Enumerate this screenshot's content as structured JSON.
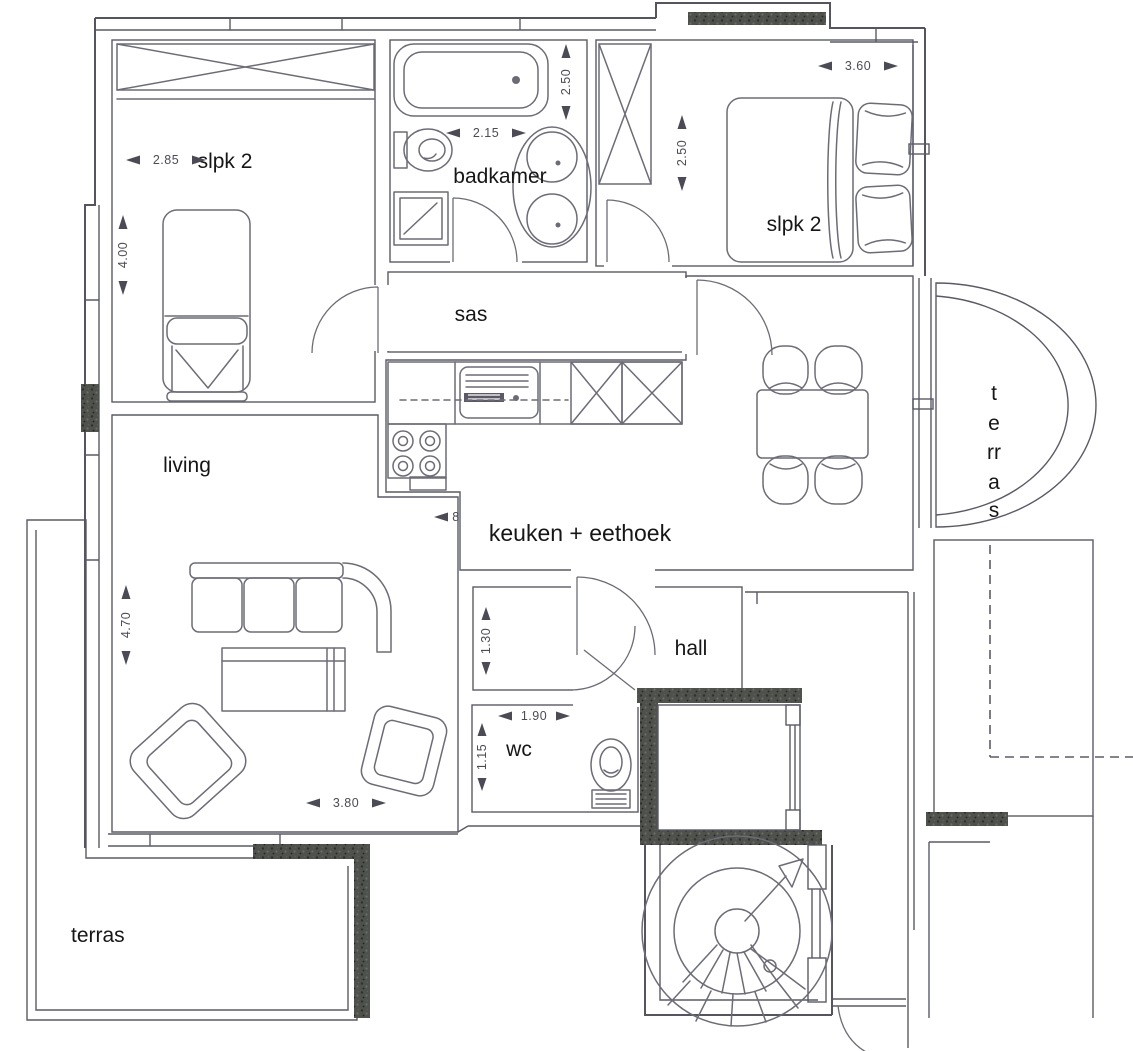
{
  "document": {
    "type": "apartment floor plan",
    "language": "Dutch"
  },
  "colors": {
    "bedroom_green": "#54c258",
    "bathroom_blue": "#b5dee3",
    "sas_orange": "#f2a46c",
    "kitchen_purple": "#9a50b0",
    "living_pink": "#f3c8d9",
    "terrace_yellow": "#f4e400",
    "wall_dark": "#4e514c",
    "paper_white": "#ffffff"
  },
  "rooms": {
    "bedroom_left": {
      "label": "slpk 2"
    },
    "bathroom": {
      "label": "badkamer"
    },
    "bedroom_right": {
      "label": "slpk 2"
    },
    "sas": {
      "label": "sas"
    },
    "kitchen": {
      "label": "keuken + eethoek"
    },
    "living": {
      "label": "living"
    },
    "hall": {
      "label": "hall"
    },
    "wc": {
      "label": "wc"
    },
    "terrace_right": {
      "label": "terras",
      "letters": [
        "t",
        "e",
        "rr",
        "a",
        "s"
      ]
    },
    "terrace_bottom": {
      "label": "terras"
    }
  },
  "dimensions": {
    "bedroom_left_width": "2.85",
    "bedroom_left_height": "4.00",
    "bathroom_width": "2.15",
    "bathroom_height": "2.50",
    "bedroom_right_width": "3.60",
    "bedroom_right_height": "2.50",
    "living_height": "4.70",
    "living_width": "3.80",
    "hall_height": "1.30",
    "wc_width": "1.90",
    "wc_height": "1.15",
    "kitchen_partial": "8"
  }
}
